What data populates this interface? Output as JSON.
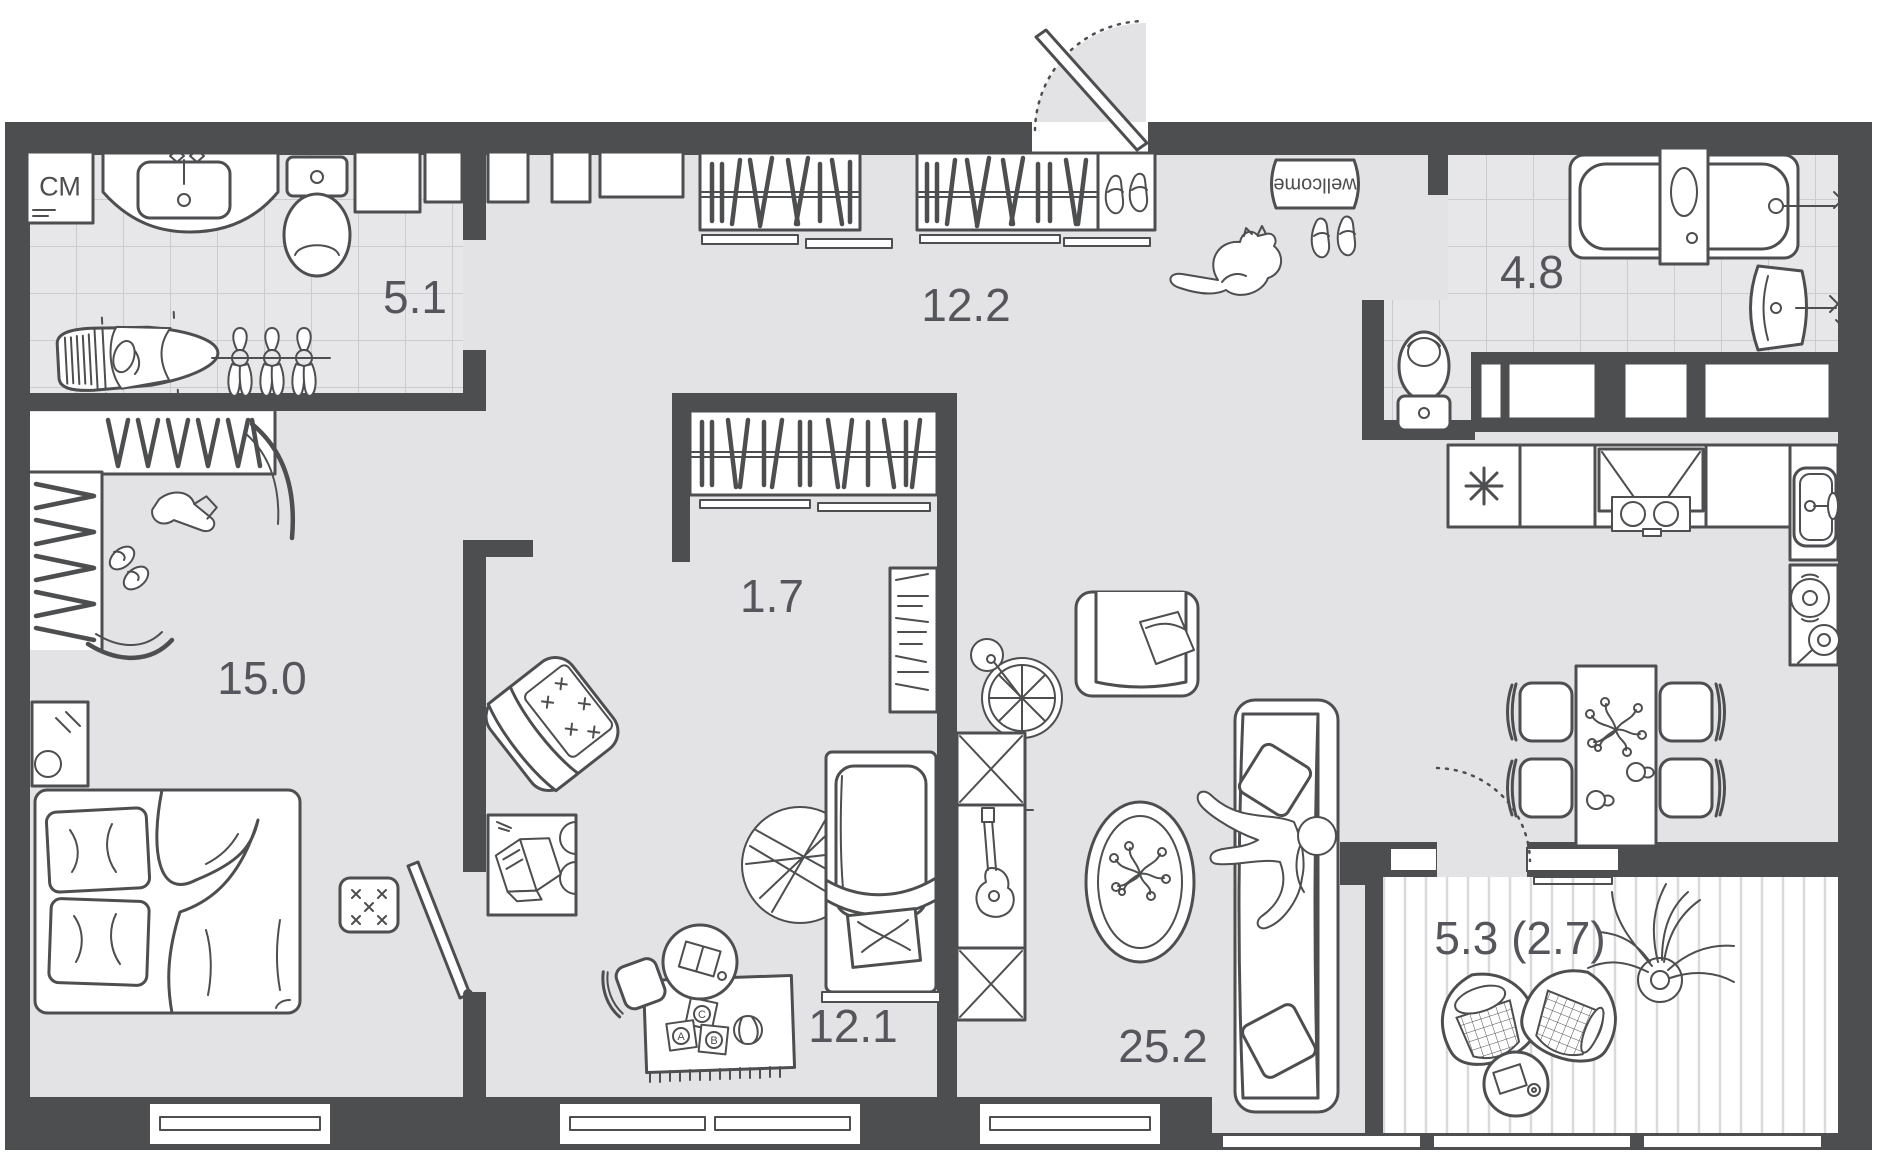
{
  "plan_title": "apartment floor plan",
  "rooms": [
    {
      "id": "bathroom-1",
      "label": "5.1"
    },
    {
      "id": "hallway",
      "label": "12.2"
    },
    {
      "id": "bathroom-2",
      "label": "4.8"
    },
    {
      "id": "bedroom",
      "label": "15.0"
    },
    {
      "id": "closet",
      "label": "1.7"
    },
    {
      "id": "kids-room",
      "label": "12.1"
    },
    {
      "id": "living-kitchen",
      "label": "25.2"
    },
    {
      "id": "balcony",
      "label": "5.3 (2.7)"
    }
  ],
  "labels": {
    "washing_machine": "СМ",
    "door_mat": "wellcome"
  },
  "toys": [
    "A",
    "B",
    "C"
  ],
  "colors": {
    "wall": "#4d4e50",
    "floor": "#e3e3e5",
    "tile_line": "#cbccce",
    "plank_line": "#dadadc",
    "label_text": "#55565b",
    "background": "#ffffff"
  },
  "icons": [
    "washing-machine-icon",
    "vanity-sink-icon",
    "toilet-icon",
    "duct-niche-icon",
    "ironing-board-icon",
    "towel-rail-icon",
    "wardrobe-hangers-icon",
    "shoe-shelf-icon",
    "entrance-door-icon",
    "welcome-mat-icon",
    "shoes-icon",
    "cat-icon",
    "bathtub-icon",
    "wall-sink-icon",
    "fridge-icon",
    "cooktop-hood-icon",
    "kitchen-sink-icon",
    "cookware-icon",
    "dining-table-icon",
    "chair-icon",
    "flowers-icon",
    "wheel-clock-icon",
    "armchair-icon",
    "tv-stand-guitar-icon",
    "oval-rug-icon",
    "sofa-icon",
    "person-icon",
    "bookshelf-icon",
    "round-rug-icon",
    "crib-icon",
    "desk-book-icon",
    "play-rug-icon",
    "toy-blocks-icon",
    "ball-icon",
    "kids-table-icon",
    "stool-icon",
    "balcony-door-icon",
    "cocoon-chair-icon",
    "balcony-table-icon",
    "plant-icon",
    "corner-wardrobe-icon",
    "boot-icon",
    "slippers-icon",
    "mirror-icon",
    "bed-icon",
    "pouf-icon",
    "door-leaf-icon",
    "window-icon"
  ]
}
